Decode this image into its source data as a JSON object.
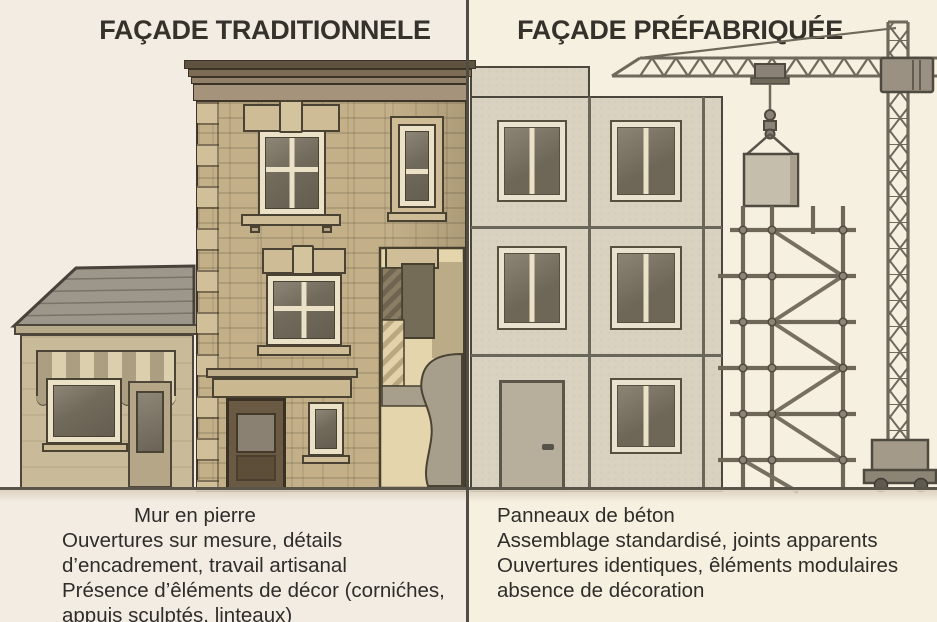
{
  "header": {
    "left_title": "FAÇADE TRADITIONNELE",
    "right_title": "FAÇADE PRÉFABRIQUÉE"
  },
  "captions": {
    "left": [
      "Mur en pierre",
      "Ouvertures sur mesure, détails",
      "d’encadrement, travail artisanal",
      "Présence d’êléments de décor (cornićhes,",
      "appuis sculptés, linteaux)"
    ],
    "right": [
      "Panneaux de béton",
      "Assemblage standardisé, joints apparents",
      "Ouvertures identiques, êléments modulaires",
      "absence de décoration"
    ]
  },
  "colors": {
    "ink": "#35322c",
    "divider": "#514d45",
    "paper_left": "#f3ece3",
    "paper_right": "#f6f0e1",
    "stone": "#c3b089",
    "stone_light": "#cdbc95",
    "frame_cream": "#eae1c6",
    "glass_dark": "#655e50",
    "wood_door": "#6b5a43",
    "prefab_panel": "#d9d2c0",
    "prefab_joint": "#6b665a",
    "metal": "#6f695c",
    "block": "#c6bead",
    "ground": "#59554b",
    "shop_wall": "#c9bb99",
    "roof": "#9c968b",
    "awning_a": "#ac9f81",
    "awning_b": "#dbcfae",
    "tan_light": "#e6d6ae"
  }
}
